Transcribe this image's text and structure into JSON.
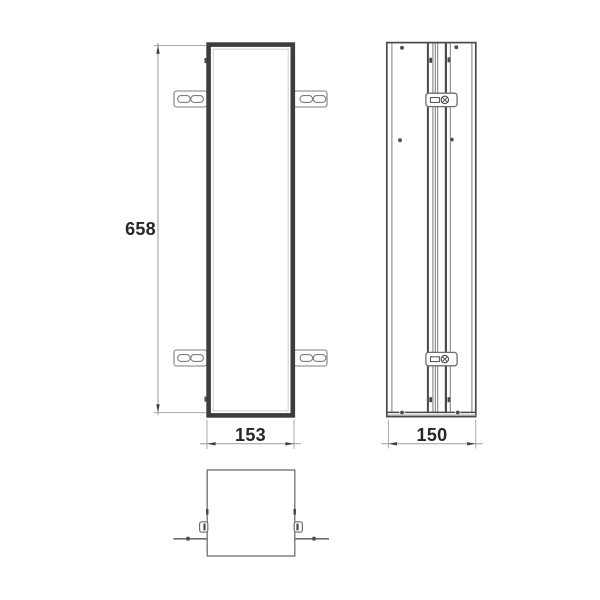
{
  "drawing": {
    "kind": "technical-dimension-drawing",
    "dimensions": {
      "height": "658",
      "width": "153",
      "depth": "150"
    },
    "colors": {
      "background": "#ffffff",
      "frame_dark": "#3d3d3d",
      "line_dark": "#4a4a4a",
      "line_mid": "#6e6e6e",
      "dimension_line": "#9b9b9b",
      "text": "#262626"
    }
  }
}
